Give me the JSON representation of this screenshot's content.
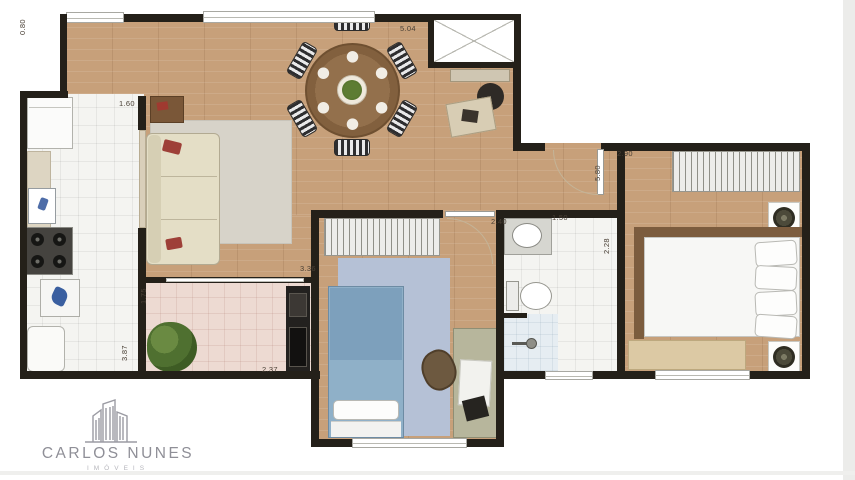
{
  "branding": {
    "name": "CARLOS NUNES",
    "tagline": "IMÓVEIS",
    "logo_icon": "buildings-outline-icon"
  },
  "floor_plan": {
    "dimensions": {
      "living_width": "5.04",
      "entry_wall": "0.80",
      "kitchen_width": "1.60",
      "kitchen_length": "3.87",
      "balcony_depth": "1.75",
      "balcony_width": "2.37",
      "bedroom2_length": "3.36",
      "bedroom2_width": "2.40",
      "bathroom_width": "1.50",
      "bathroom_length": "2.28",
      "suite_length": "5.80",
      "suite_width": "2.90"
    },
    "colors": {
      "wall": "#242019",
      "wood_floor": "#c7a07a",
      "tile_floor": "#f4f4f1",
      "balcony_tile": "#eddad2",
      "accent_red": "#9e4038",
      "bed_blue": "#8fb0c8",
      "logo_gray": "#8f8f97"
    }
  }
}
